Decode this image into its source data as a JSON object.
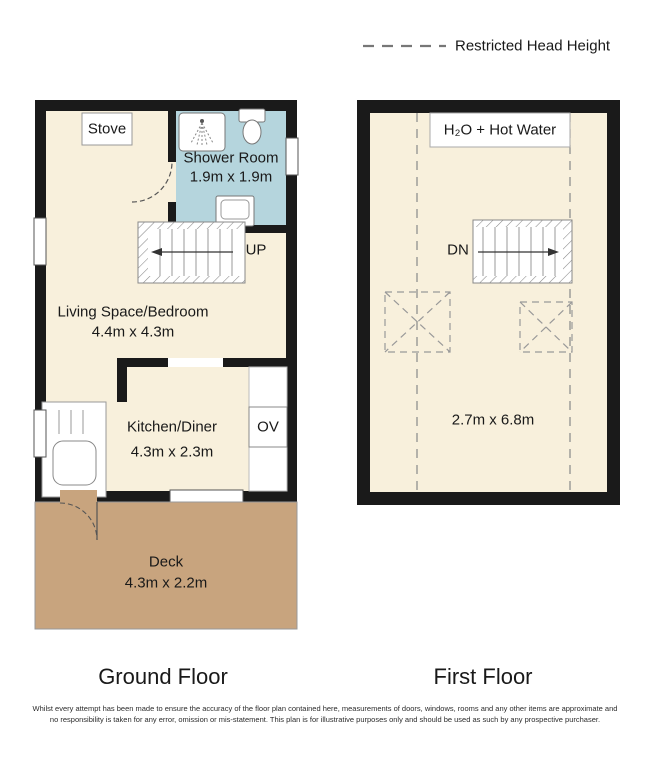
{
  "legend": {
    "restricted_label": "Restricted Head Height"
  },
  "ground_floor": {
    "title": "Ground Floor",
    "stove_label": "Stove",
    "shower_room": {
      "name": "Shower Room",
      "dims": "1.9m x 1.9m"
    },
    "stairs_label": "UP",
    "living": {
      "name": "Living Space/Bedroom",
      "dims": "4.4m x 4.3m"
    },
    "kitchen": {
      "name": "Kitchen/Diner",
      "dims": "4.3m x 2.3m"
    },
    "oven_label": "OV",
    "deck": {
      "name": "Deck",
      "dims": "4.3m x 2.2m"
    }
  },
  "first_floor": {
    "title": "First Floor",
    "water_label": "H₂O + Hot Water",
    "stairs_label": "DN",
    "dims": "2.7m x 6.8m"
  },
  "disclaimer": {
    "line1": "Whilst every attempt has been made to ensure the accuracy of the floor plan contained here, measurements of doors, windows, rooms and any other items are approximate and",
    "line2": "no responsibility is taken for any error, omission or mis-statement. This plan is for illustrative purposes only and should be used as such by any prospective purchaser."
  },
  "colors": {
    "floor": "#f8f0dc",
    "shower_room": "#b5d5dd",
    "deck": "#c8a47e",
    "wall": "#1a1a1a"
  }
}
